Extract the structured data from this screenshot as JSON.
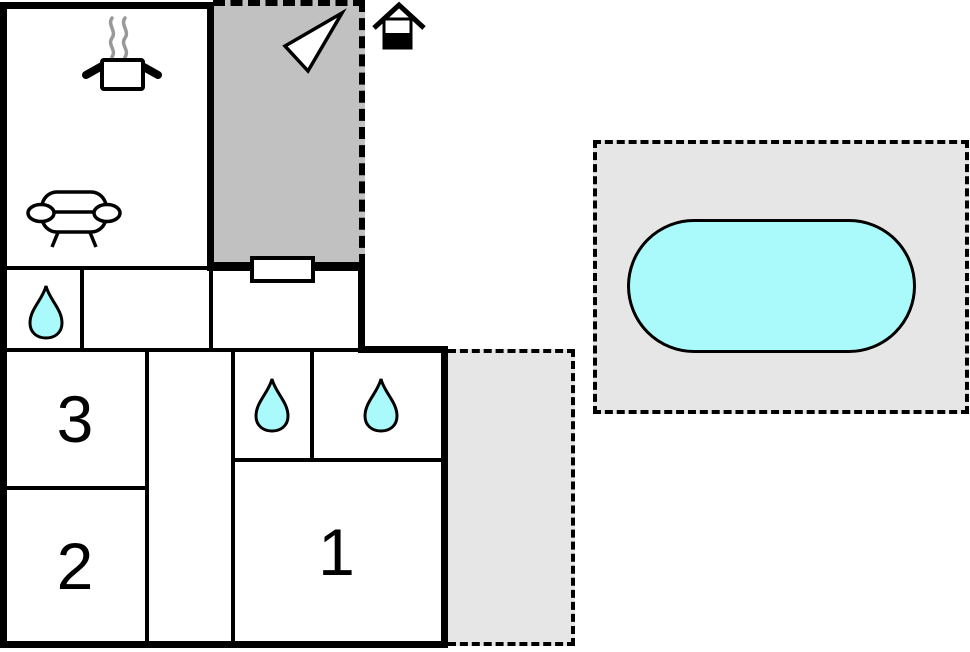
{
  "rooms": {
    "bedroom1": {
      "label": "1"
    },
    "bedroom2": {
      "label": "2"
    },
    "bedroom3": {
      "label": "3"
    }
  },
  "colors": {
    "wall": "#000000",
    "terrace": "#c1c1c1",
    "outdoor": "#e6e6e6",
    "water": "#aafafc",
    "steam": "#999999",
    "canvas": "#ffffff",
    "door": "#ffffff"
  },
  "icons": {
    "kitchen": "cooking-pot-icon",
    "living_room": "sofa-icon",
    "terrace": "north-arrow-icon",
    "entrance": "house-icon",
    "bathrooms": "water-drop-icon",
    "outdoor": "swimming-pool"
  }
}
